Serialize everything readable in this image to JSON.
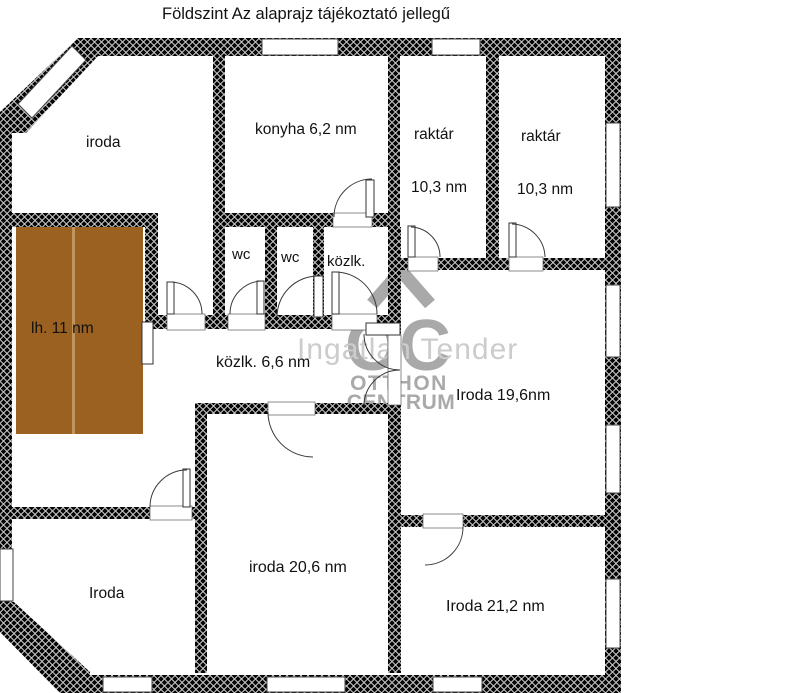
{
  "title": "Földszint Az alaprajz tájékoztató jellegű",
  "watermark": {
    "logo_monogram": "OC",
    "brand_line1": "OTTHON",
    "brand_line2": "CENTRUM",
    "overlay_text": "Ingatlan Tender"
  },
  "colors": {
    "wall": "#050505",
    "staircase": "#9a6120",
    "staircase_divider": "#c0945c",
    "watermark_gray": "#a9a9a9",
    "watermark_light": "#cccccc"
  },
  "rooms": {
    "office_top_left": {
      "label": "iroda"
    },
    "kitchen": {
      "label": "konyha 6,2 nm"
    },
    "storage_1": {
      "label": "raktár",
      "area": "10,3 nm"
    },
    "storage_2": {
      "label": "raktár",
      "area": "10,3 nm"
    },
    "wc_1": {
      "label": "wc"
    },
    "wc_2": {
      "label": "wc"
    },
    "hall_small": {
      "label": "közlk."
    },
    "staircase": {
      "label": "lh. 11 nm"
    },
    "hall_main": {
      "label": "közlk. 6,6 nm"
    },
    "office_right": {
      "label": "Iroda 19,6nm"
    },
    "office_center": {
      "label": "iroda 20,6 nm"
    },
    "office_bottom_left": {
      "label": "Iroda"
    },
    "office_bottom_right": {
      "label": "Iroda 21,2 nm"
    }
  }
}
